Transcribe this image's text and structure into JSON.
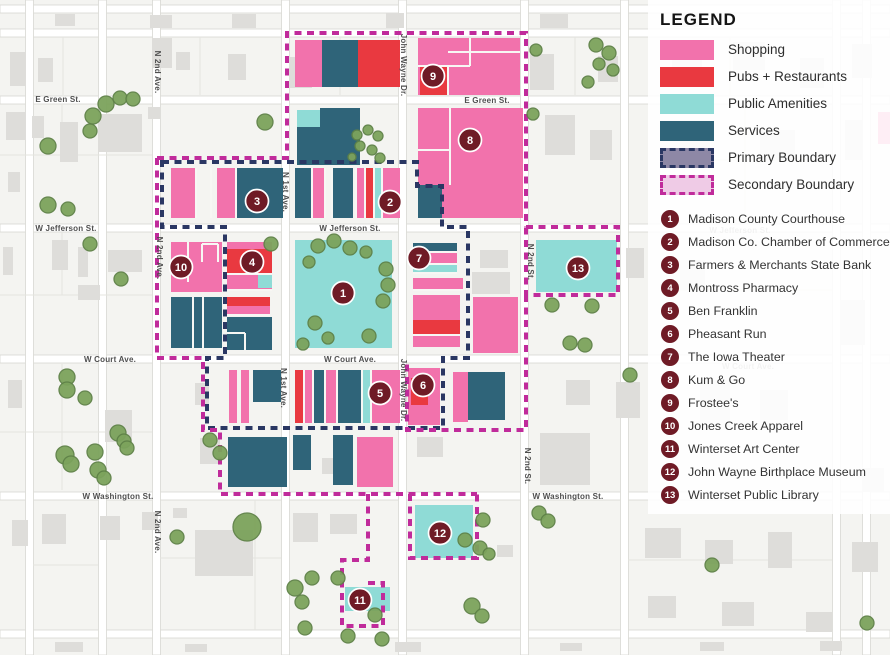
{
  "legend": {
    "title": "LEGEND",
    "categories": [
      {
        "label": "Shopping",
        "color": "#F272AC"
      },
      {
        "label": "Pubs + Restaurants",
        "color": "#E93940"
      },
      {
        "label": "Public Amenities",
        "color": "#8FDBD6"
      },
      {
        "label": "Services",
        "color": "#2F6479"
      },
      {
        "label": "Primary Boundary",
        "fill": "#8E88A6",
        "border": "#2A3763",
        "style": "dashed"
      },
      {
        "label": "Secondary Boundary",
        "fill": "#EFCBE6",
        "border": "#C02B9B",
        "style": "dashed"
      }
    ]
  },
  "places": [
    {
      "number": "1",
      "name": "Madison County Courthouse"
    },
    {
      "number": "2",
      "name": "Madison Co. Chamber of Commerce"
    },
    {
      "number": "3",
      "name": "Farmers & Merchants State Bank"
    },
    {
      "number": "4",
      "name": "Montross Pharmacy"
    },
    {
      "number": "5",
      "name": "Ben Franklin"
    },
    {
      "number": "6",
      "name": "Pheasant Run"
    },
    {
      "number": "7",
      "name": "The Iowa Theater"
    },
    {
      "number": "8",
      "name": "Kum & Go"
    },
    {
      "number": "9",
      "name": "Frostee's"
    },
    {
      "number": "10",
      "name": "Jones Creek Apparel"
    },
    {
      "number": "11",
      "name": "Winterset Art Center"
    },
    {
      "number": "12",
      "name": "John Wayne Birthplace Museum"
    },
    {
      "number": "13",
      "name": "Winterset Public Library"
    }
  ],
  "streets": {
    "e_green": "E Green St.",
    "w_jefferson": "W Jefferson St.",
    "w_court": "W Court Ave.",
    "w_washington": "W Washington St.",
    "n_2nd_ave": "N 2nd Ave.",
    "n_1st_ave": "N 1st Ave.",
    "john_wayne_dr": "John Wayne Dr.",
    "n_2nd_st": "N 2nd St."
  },
  "colors": {
    "shopping": "#F272AC",
    "pubs_restaurants": "#E93940",
    "public_amenities": "#8FDBD6",
    "services": "#2F6479",
    "primary_boundary": "#2A3763",
    "secondary_boundary": "#C02B9B",
    "marker": "#6F1B26",
    "tree": "#7CA35C"
  }
}
